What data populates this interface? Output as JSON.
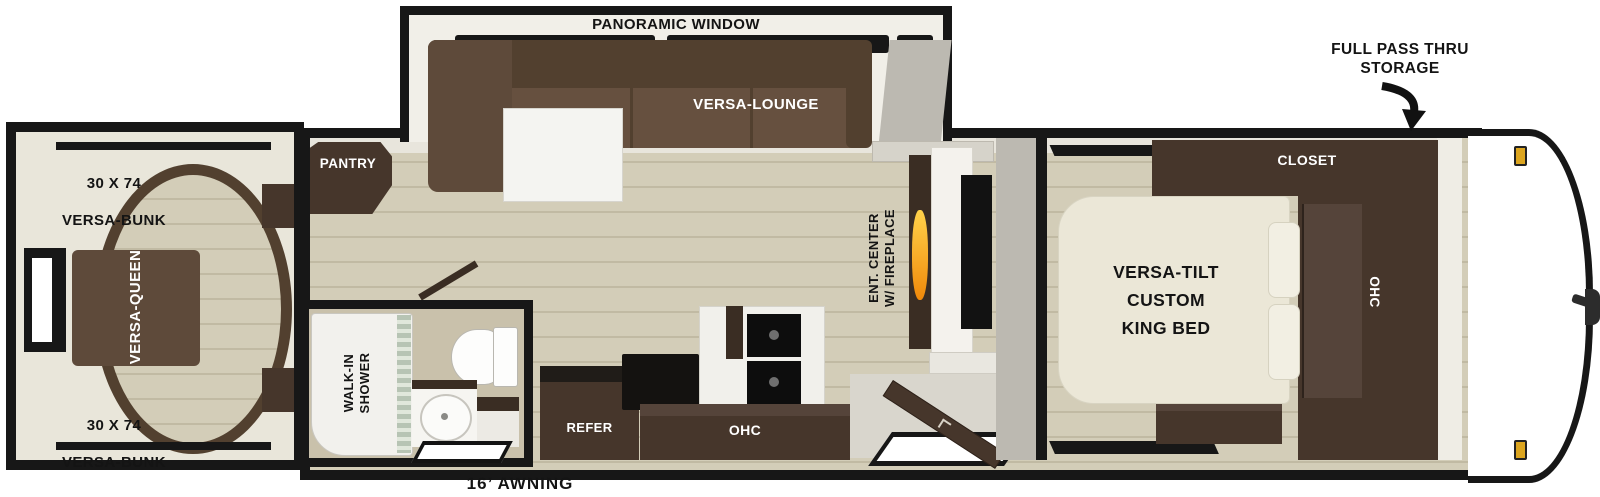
{
  "floorplan": {
    "rear_bedroom": {
      "bunk_top": {
        "size": "30 X 74",
        "name": "VERSA-BUNK"
      },
      "bunk_bottom": {
        "size": "30 X 74",
        "name": "VERSA-BUNK"
      },
      "queen": "VERSA-QUEEN"
    },
    "bathroom": {
      "shower": "WALK-IN\nSHOWER"
    },
    "kitchen_living": {
      "pantry": "PANTRY",
      "panoramic_window": "PANORAMIC WINDOW",
      "lounge": "VERSA-LOUNGE",
      "refer": "REFER",
      "ohc": "OHC",
      "ent_center": "ENT. CENTER\nW/ FIREPLACE"
    },
    "front_bedroom": {
      "bed": "VERSA-TILT\nCUSTOM\nKING BED",
      "closet": "CLOSET",
      "ohc": "OHC"
    },
    "exterior": {
      "storage": "FULL PASS THRU\nSTORAGE",
      "awning": "16’ AWNING"
    }
  },
  "colors": {
    "wall": "#171717",
    "cabinet": "#46362b",
    "cabinetdark": "#3a2d23",
    "cabinetlight": "#55443a",
    "sofa": "#5e4a3a",
    "sofadark": "#52402f",
    "floor": "#d3cdb8",
    "floorline": "#c1baa3",
    "cream": "#e9e6da",
    "bed": "#ebe7d7",
    "bathfloor": "#c9c1ab",
    "flame": "#f0890a",
    "amber": "#dca51f",
    "graywall": "#bcb9b1"
  }
}
